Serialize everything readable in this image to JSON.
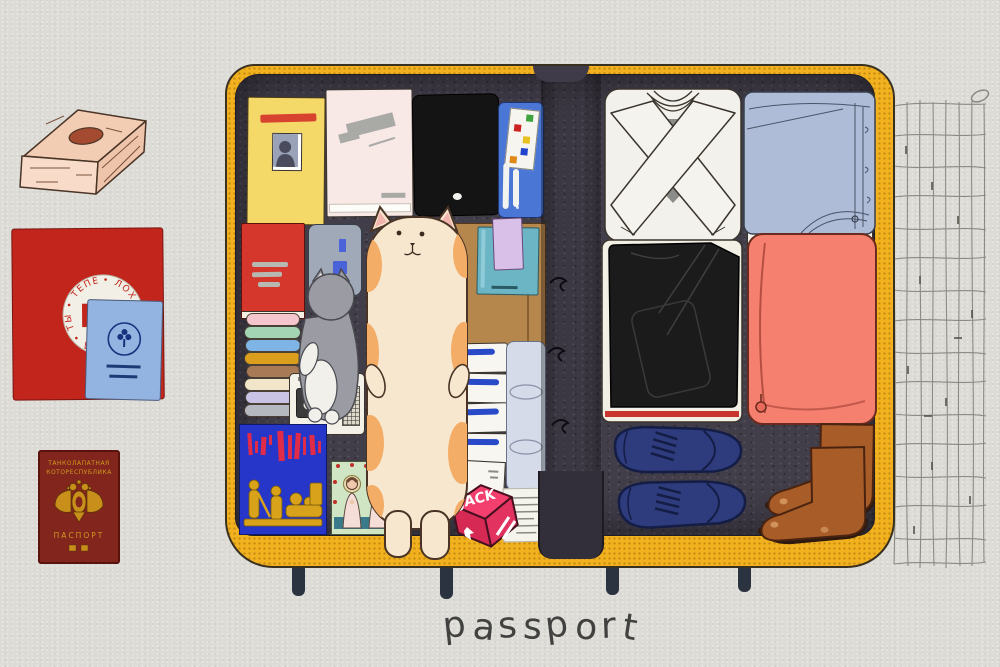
{
  "scene": {
    "caption": "passport",
    "style": "hand-drawn illustration of an open suitcase being packed"
  },
  "palette": {
    "paper": "#dcdbd6",
    "shell_yellow": "#f2b21f",
    "lining_charcoal": "#413d49",
    "coral_cube": "#f5806f",
    "navy_shoes": "#2e3b7c",
    "brown_boots": "#a85c28",
    "cat_cream": "#f8e7cf",
    "cat_orange": "#f4ad67",
    "accent_red": "#d5372c",
    "accent_blue": "#4a76d6"
  },
  "documents": {
    "red_folder": {
      "monogram": "РВ",
      "ring_text": "• ЛОХ • ХАХА • АХА • ТЫ • ТЕПЕРЬ"
    },
    "red_passport": {
      "line1": "ТАНКОЛАПАТНАЯ",
      "line2": "КОТОРЕСПУБЛИКА",
      "label": "ПАСПОРТ"
    }
  },
  "suitcase": {
    "stickers": {
      "jack": "JACK"
    },
    "left_half_items": [
      "yellow ID card with photo",
      "pale pink sketchbook",
      "black laptop",
      "blue pouch with sticker panel",
      "red book",
      "gray e-reader",
      "stack of folded clothes",
      "small gray cat plush",
      "cassette recorder",
      "blue art book with red strokes",
      "icon postcard with two figures",
      "long cream cat plush",
      "brown paper box",
      "teal notebook",
      "lavender notebook",
      "four white medicine boxes",
      "plastic bottle",
      "small white box",
      "paper receipt",
      "pink JACK cube sticker"
    ],
    "right_half_items": [
      "white folded sweater",
      "light blue folded shirt",
      "black folded jacket on white shirts with red trim",
      "coral packing cube",
      "navy sneakers",
      "brown leather boots"
    ]
  },
  "outside_items": [
    "peach wooden box",
    "red folder with round seal",
    "blue booklet with emblem",
    "dark red passport with gold eagle",
    "elastic luggage net",
    "four suitcase pegs"
  ]
}
